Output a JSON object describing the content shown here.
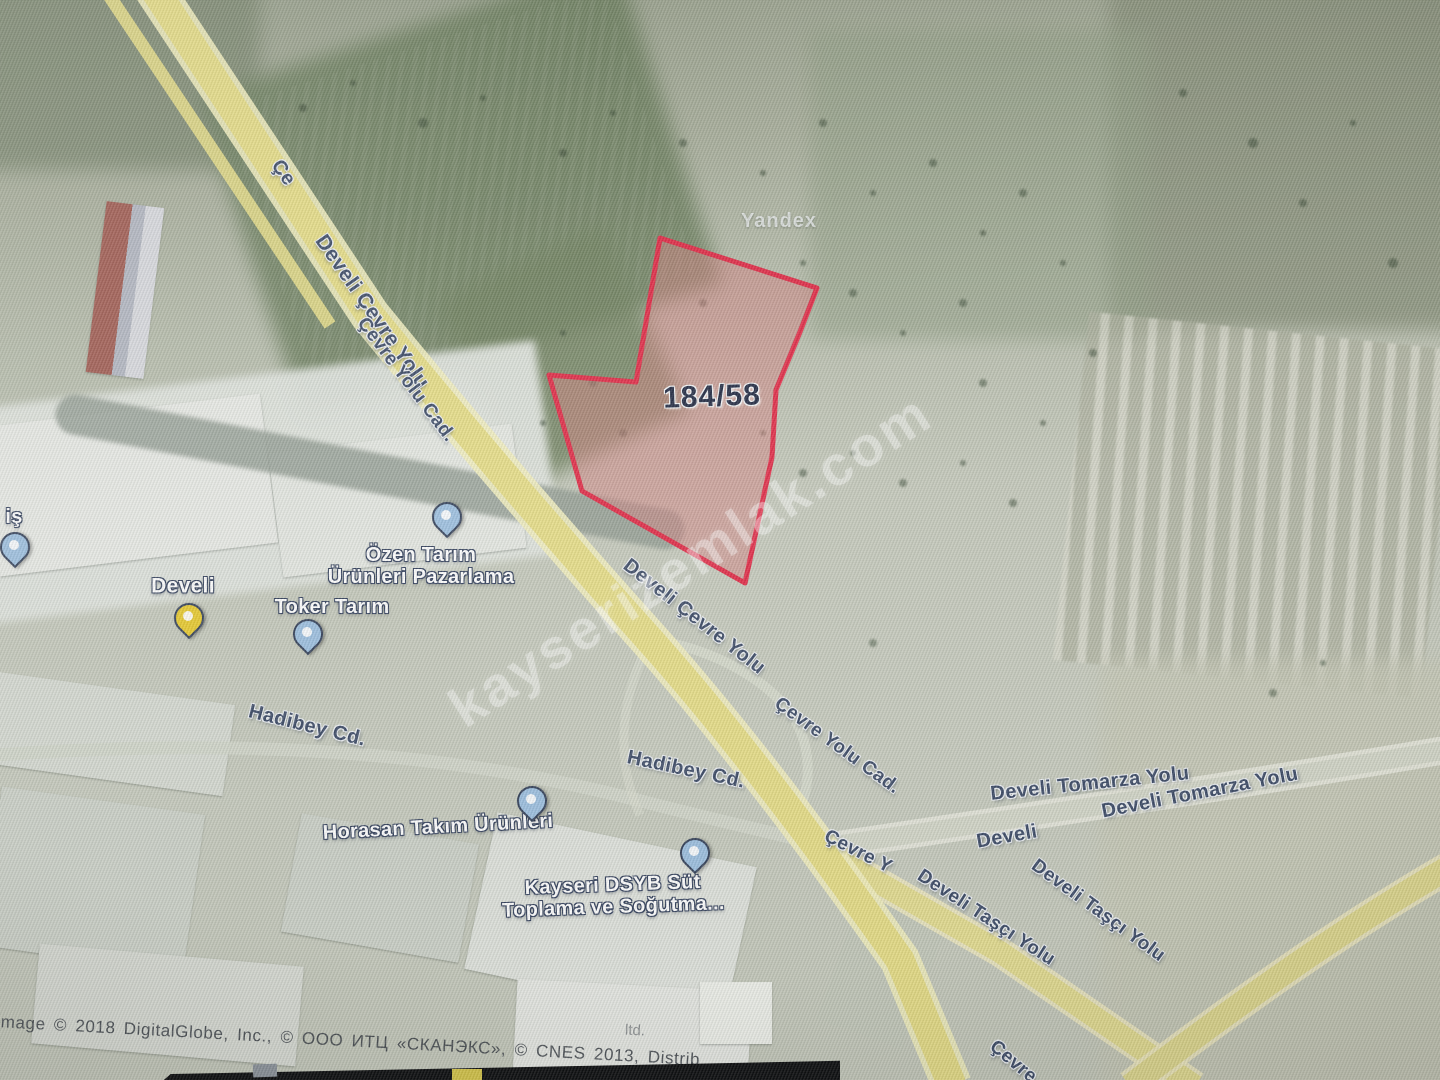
{
  "watermarks": {
    "provider": "Yandex",
    "site": "kayserizemlak.com"
  },
  "parcel": {
    "label": "184/58",
    "x": 712,
    "y": 397,
    "rot": -2
  },
  "road_labels": [
    {
      "text": "Çe",
      "x": 283,
      "y": 173,
      "rot": 55,
      "size": 20
    },
    {
      "text": "Develi Çevre Yolu",
      "x": 372,
      "y": 312,
      "rot": 55,
      "size": 21
    },
    {
      "text": "Çevre Yolu Cad.",
      "x": 406,
      "y": 380,
      "rot": 53,
      "size": 19
    },
    {
      "text": "Develi Çevre Yolu",
      "x": 694,
      "y": 617,
      "rot": 38,
      "size": 20
    },
    {
      "text": "Çevre Yolu Cad.",
      "x": 837,
      "y": 746,
      "rot": 36,
      "size": 19
    },
    {
      "text": "Hadibey Cd.",
      "x": 307,
      "y": 726,
      "rot": 14,
      "size": 20
    },
    {
      "text": "Hadibey Cd.",
      "x": 686,
      "y": 770,
      "rot": 12,
      "size": 20
    },
    {
      "text": "Develi Tomarza Yolu",
      "x": 1090,
      "y": 784,
      "rot": -6,
      "size": 20
    },
    {
      "text": "Develi",
      "x": 1007,
      "y": 837,
      "rot": -10,
      "size": 20
    },
    {
      "text": "Develi Tomarza Yolu",
      "x": 1200,
      "y": 793,
      "rot": -11,
      "size": 20
    },
    {
      "text": "Çevre Y",
      "x": 858,
      "y": 852,
      "rot": 27,
      "size": 19
    },
    {
      "text": "Develi Taşçı Yolu",
      "x": 986,
      "y": 918,
      "rot": 33,
      "size": 19
    },
    {
      "text": "Develi Taşçı Yolu",
      "x": 1098,
      "y": 911,
      "rot": 36,
      "size": 19
    },
    {
      "text": "Çevre",
      "x": 1013,
      "y": 1062,
      "rot": 40,
      "size": 19
    }
  ],
  "poi_labels": [
    {
      "text": "Develi",
      "x": 183,
      "y": 586,
      "rot": 0,
      "size": 21
    },
    {
      "text": "Özen Tarım\nÜrünleri Pazarlama",
      "x": 421,
      "y": 566,
      "rot": 0,
      "size": 20
    },
    {
      "text": "Toker Tarım",
      "x": 332,
      "y": 607,
      "rot": 0,
      "size": 20
    },
    {
      "text": "iş",
      "x": 14,
      "y": 517,
      "rot": 0,
      "size": 20
    },
    {
      "text": "Horasan Takım Ürünleri",
      "x": 438,
      "y": 827,
      "rot": -3,
      "size": 20
    },
    {
      "text": "Kayseri DSYB Süt\nToplama ve Soğutma...",
      "x": 613,
      "y": 896,
      "rot": -2,
      "size": 20
    }
  ],
  "pins": [
    {
      "color": "yellow",
      "x": 188,
      "y": 620
    },
    {
      "color": "blue",
      "x": 446,
      "y": 519
    },
    {
      "color": "blue",
      "x": 307,
      "y": 636
    },
    {
      "color": "blue",
      "x": 14,
      "y": 549
    },
    {
      "color": "blue",
      "x": 531,
      "y": 803
    },
    {
      "color": "blue",
      "x": 694,
      "y": 855
    }
  ],
  "attribution": {
    "text": "Image © 2018 DigitalGlobe, Inc., © ООО ИТЦ «СКАНЭКС», © CNES 2013, Distrib",
    "extra": "ltd."
  },
  "colors": {
    "parcel_fill": "#d47c7c",
    "parcel_stroke": "#e02844",
    "road_yellow": "#e6dd86",
    "road_casing": "#f2eebe",
    "pin_blue": "#9dc0e0",
    "pin_yellow": "#e8ca2d"
  }
}
